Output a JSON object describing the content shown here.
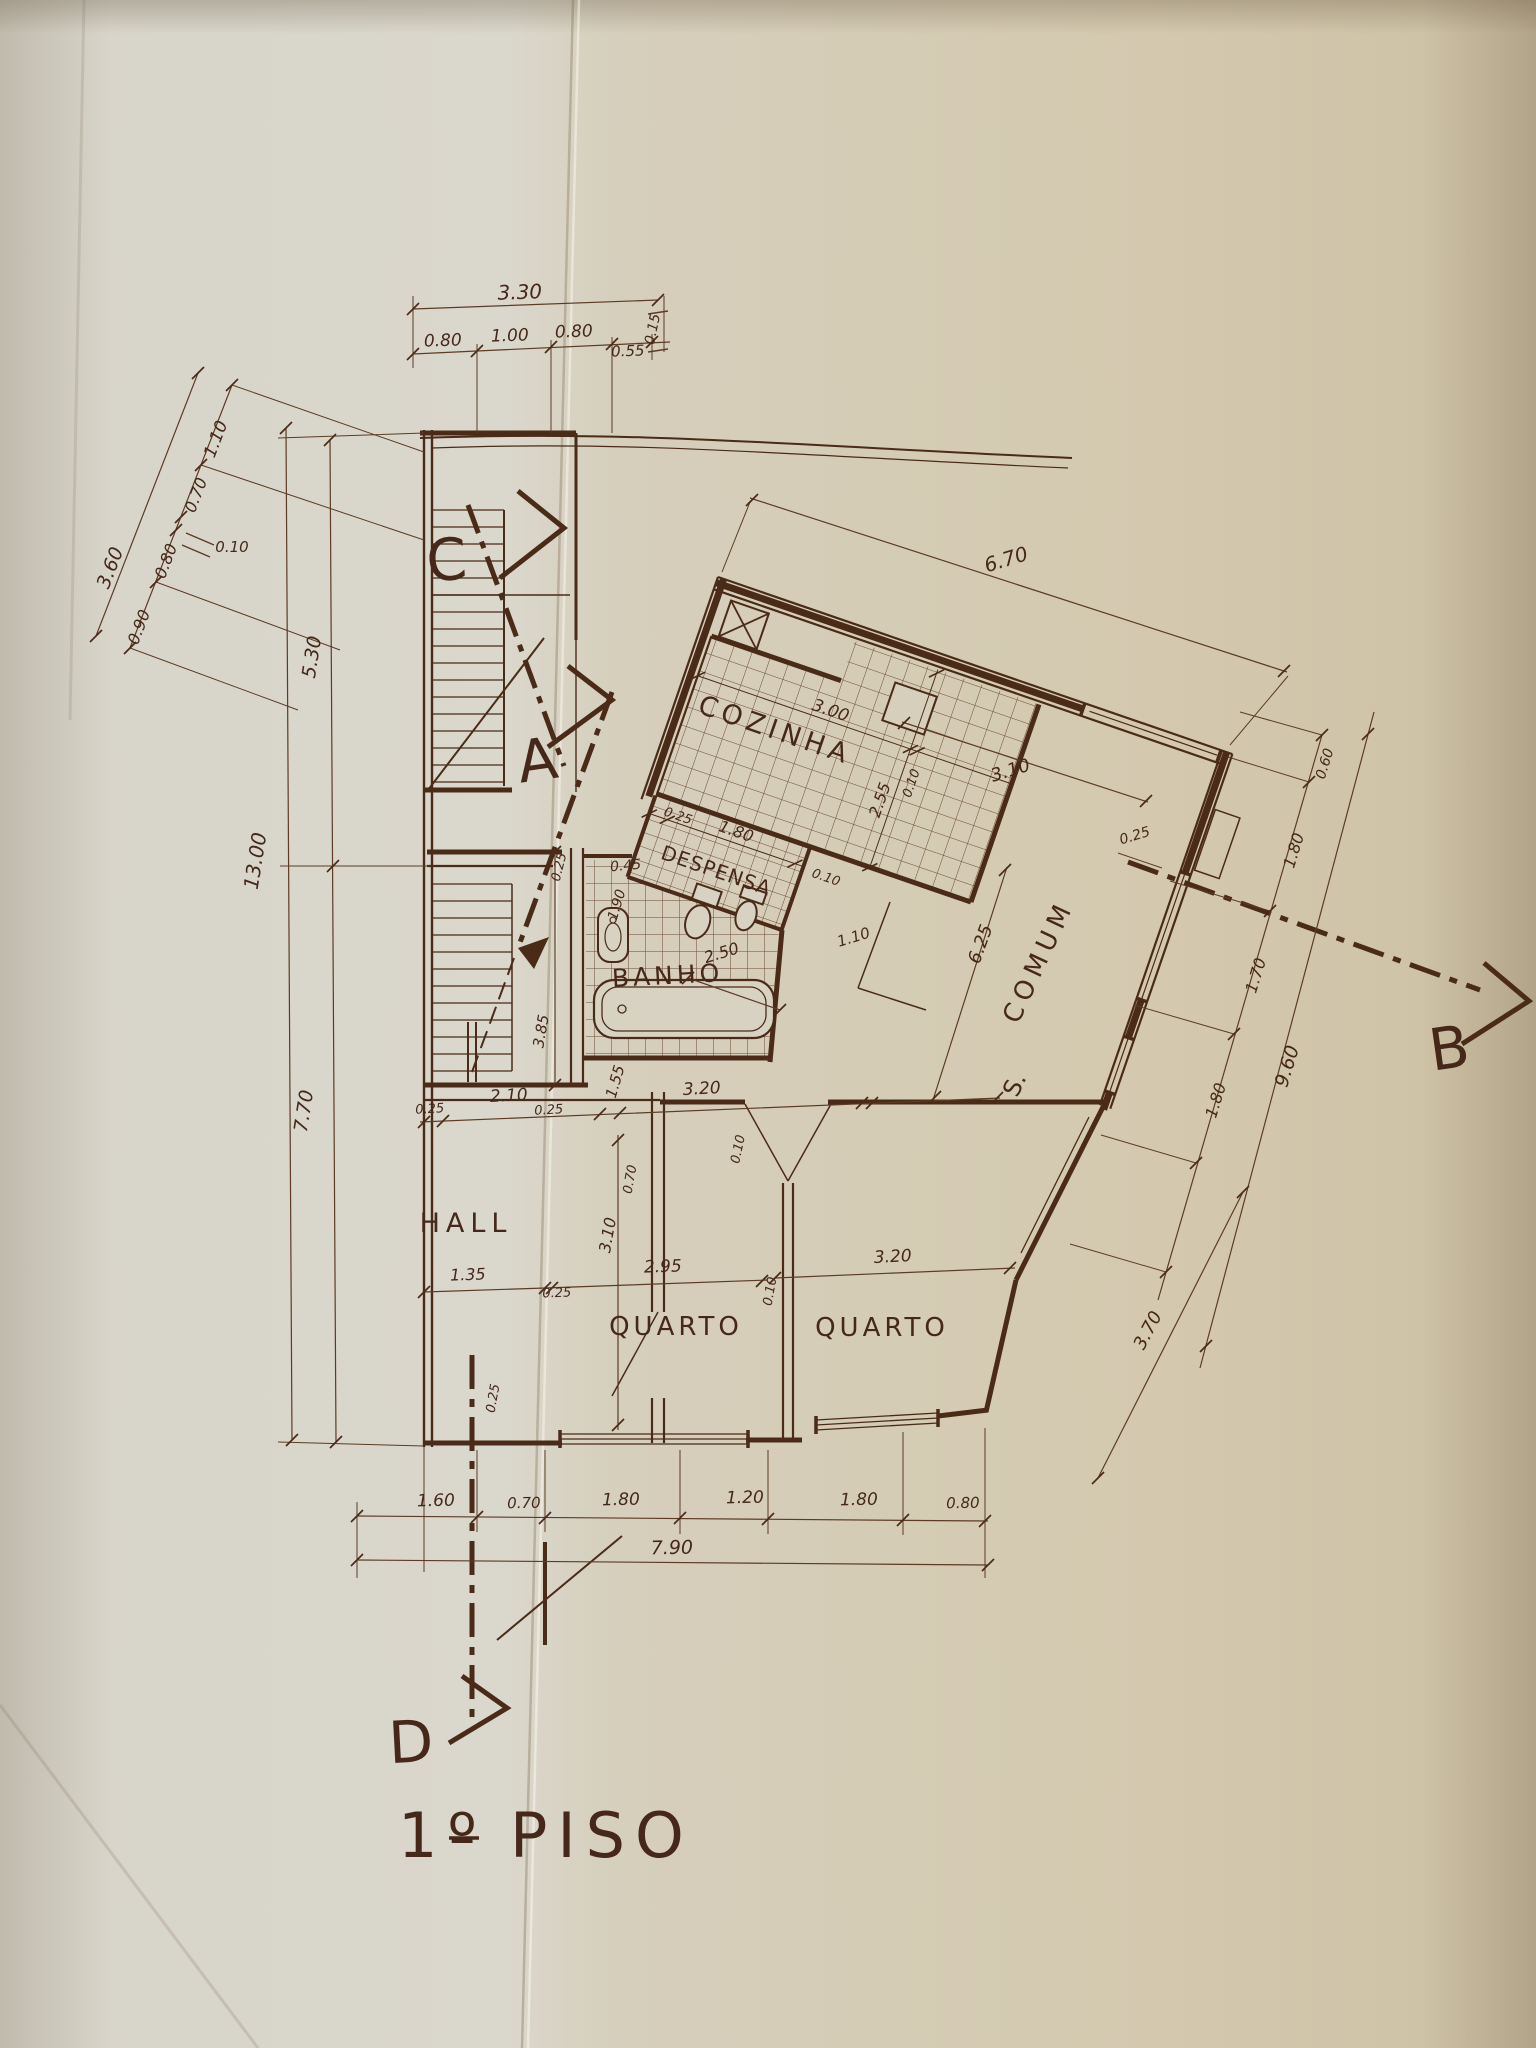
{
  "drawing_title": "1º PISO",
  "title": {
    "num": "1º",
    "word": "PISO"
  },
  "rooms": {
    "cozinha": "COZINHA",
    "despensa": "DESPENSA",
    "banho": "BANHO",
    "hall": "HALL",
    "quarto_left": "QUARTO",
    "quarto_right": "QUARTO",
    "sala_prefix": "S.",
    "sala": "COMUM"
  },
  "sections": {
    "a": "A",
    "b": "B",
    "c": "C",
    "d": "D"
  },
  "dims": {
    "top_overall": "3.30",
    "top_seg1": "0.80",
    "top_seg2": "1.00",
    "top_seg3": "0.80",
    "top_seg4": "0.55",
    "top_end": "0.15",
    "nw_overall": "3.60",
    "nw_seg1": "1.10",
    "nw_seg2": "0.70",
    "nw_callout": "0.10",
    "nw_seg3": "0.80",
    "nw_seg4": "0.90",
    "left_total": "13.00",
    "left_upper": "5.30",
    "left_lower": "7.70",
    "block_top": "6.70",
    "window_top_right": "3.10",
    "wall_top_right": "0.25",
    "kitchen_w": "3.00",
    "kitchen_d": "2.55",
    "kitchen_wall": "0.10",
    "kitchen_low": "0.10",
    "despensa_wall": "0.25",
    "despensa_w": "1.80",
    "bath_wall": "0.25",
    "bath_nook": "0.45",
    "bath_d": "1.90",
    "bath_w": "2.50",
    "bath_total": "3.85",
    "bath_low": "1.55",
    "sala_door": "1.10",
    "sala_len": "6.25",
    "right_seg1": "0.60",
    "right_seg2": "1.80",
    "right_seg3": "1.70",
    "right_seg4": "1.80",
    "right_total": "9.60",
    "mid_wall1": "0.25",
    "hall_w": "2.10",
    "mid_wall2": "0.25",
    "mid_span": "3.20",
    "mid_thin": "0.10",
    "q1_top": "0.70",
    "q1_h": "3.10",
    "hall_low": "1.35",
    "q1_w": "2.95",
    "q_wall_low": "0.25",
    "q_divider": "0.10",
    "q2_w": "3.20",
    "q_wall_bottom": "0.25",
    "q2_side": "3.70",
    "bot_seg1": "1.60",
    "bot_seg2": "0.70",
    "bot_seg3": "1.80",
    "bot_seg4": "1.20",
    "bot_seg5": "1.80",
    "bot_seg6": "0.80",
    "bot_total": "7.90"
  },
  "colors": {
    "ink": "#4a2b17",
    "ink_light": "#5d3b24",
    "paper_left": "#dad7cc",
    "paper_right": "#d3c8ae"
  }
}
